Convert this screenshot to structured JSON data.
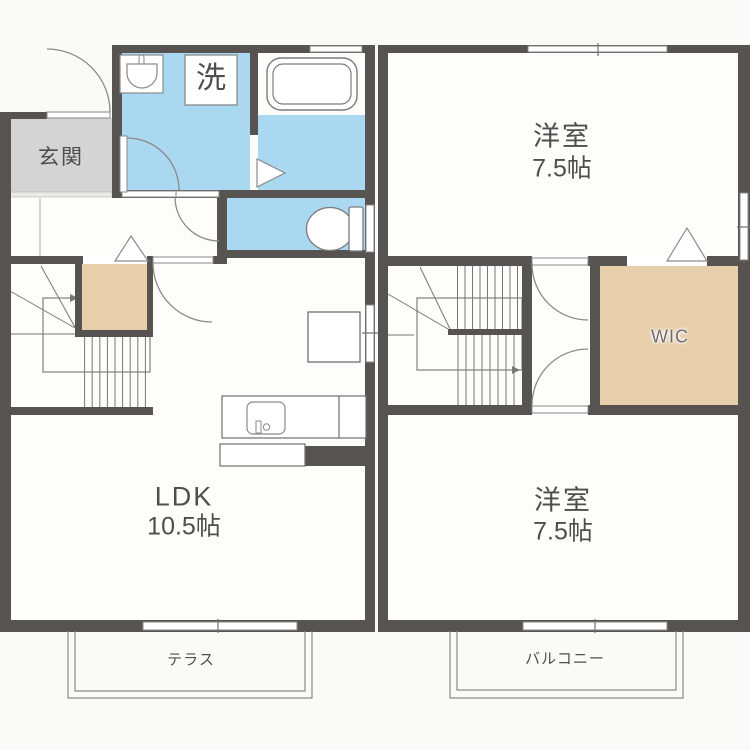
{
  "unit_1f": {
    "entrance_label": "玄関",
    "laundry_label": "洗",
    "ldk_name": "LDK",
    "ldk_size": "10.5帖",
    "terrace_label": "テラス"
  },
  "unit_2f": {
    "bedroom_upper_name": "洋室",
    "bedroom_upper_size": "7.5帖",
    "wic_label": "WIC",
    "bedroom_lower_name": "洋室",
    "bedroom_lower_size": "7.5帖",
    "balcony_label": "バルコニー"
  },
  "colors": {
    "wall": "#565350",
    "wet_area_blue": "#a9d8f0",
    "closet_tan": "#e7cfac",
    "entrance_gray": "#d4d4d4"
  }
}
